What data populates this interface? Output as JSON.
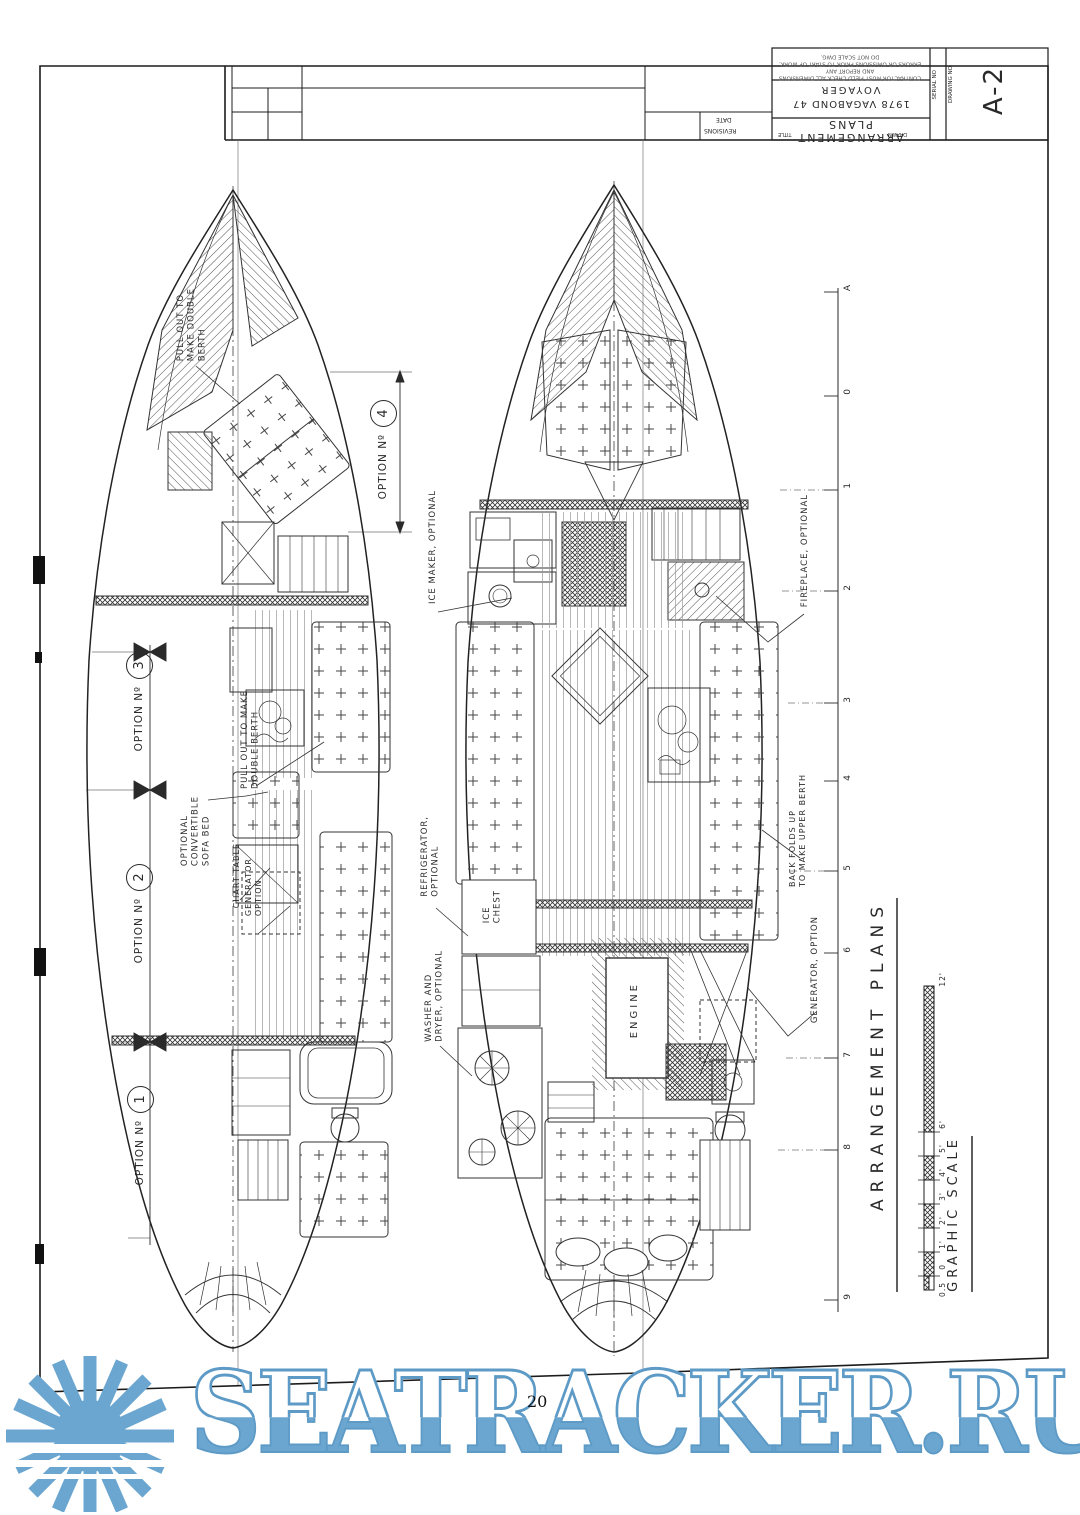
{
  "page_number": "20",
  "watermark": {
    "text": "SEATRACKER.RU",
    "color": "#6ba6d0"
  },
  "revision_strip": {
    "date_label": "DATE",
    "revisions_label": "REVISIONS"
  },
  "title_block": {
    "note_line1": "CONTRACTOR MUST FIELD CHECK ALL DIMENSIONS AND REPORT ANY",
    "note_line2": "ERRORS OR OMISSIONS PRIOR TO START OF WORK. DO NOT SCALE DWG.",
    "boat_line1": "VOYAGER",
    "boat_line2": "1978 VAGABOND 47",
    "sheet_title": "ARRANGEMENT  PLANS",
    "drawn_label": "DRAWN",
    "title_label": "TITLE",
    "serial_no_label": "SERIAL NO",
    "drawing_no_label": "DRAWING NO",
    "drawing_no": "A-2"
  },
  "stations": {
    "labels": [
      "A",
      "0",
      "1",
      "2",
      "3",
      "4",
      "5",
      "6",
      "7",
      "8",
      "9"
    ]
  },
  "options_plan": {
    "berth_note": "PULL OUT TO\nMAKE DOUBLE\nBERTH",
    "option_labels": [
      {
        "prefix": "OPTION Nº",
        "num": "4"
      },
      {
        "prefix": "OPTION Nº",
        "num": "3"
      },
      {
        "prefix": "OPTION Nº",
        "num": "2"
      },
      {
        "prefix": "OPTION Nº",
        "num": "1"
      }
    ],
    "fold_out_note": "PULL OUT TO MAKE\nDOUBLE BERTH",
    "sofa_note": "OPTIONAL\nCONVERTIBLE\nSOFA BED",
    "chart_table_note": "CHART TABLE",
    "generator_note": "GENERATOR\nOPTION"
  },
  "main_plan": {
    "ice_maker_note": "ICE MAKER, OPTIONAL",
    "fireplace_note": "FIREPLACE, OPTIONAL",
    "refrigerator_note": "REFRIGERATOR,\nOPTIONAL",
    "ice_chest_label": "ICE\nCHEST",
    "washer_note": "WASHER AND\nDRYER, OPTIONAL",
    "engine_label": "ENGINE",
    "generator_note": "GENERATOR, OPTION",
    "upper_berth_note": "BACK FOLDS UP\nTO MAKE UPPER BERTH"
  },
  "footer": {
    "drawing_title": "ARRANGEMENT   PLANS",
    "graphic_scale_label": "GRAPHIC  SCALE",
    "scale_ticks": [
      "12'",
      "6'",
      "5'",
      "4'",
      "3'",
      "2'",
      "1'",
      "0",
      "0.5"
    ]
  }
}
